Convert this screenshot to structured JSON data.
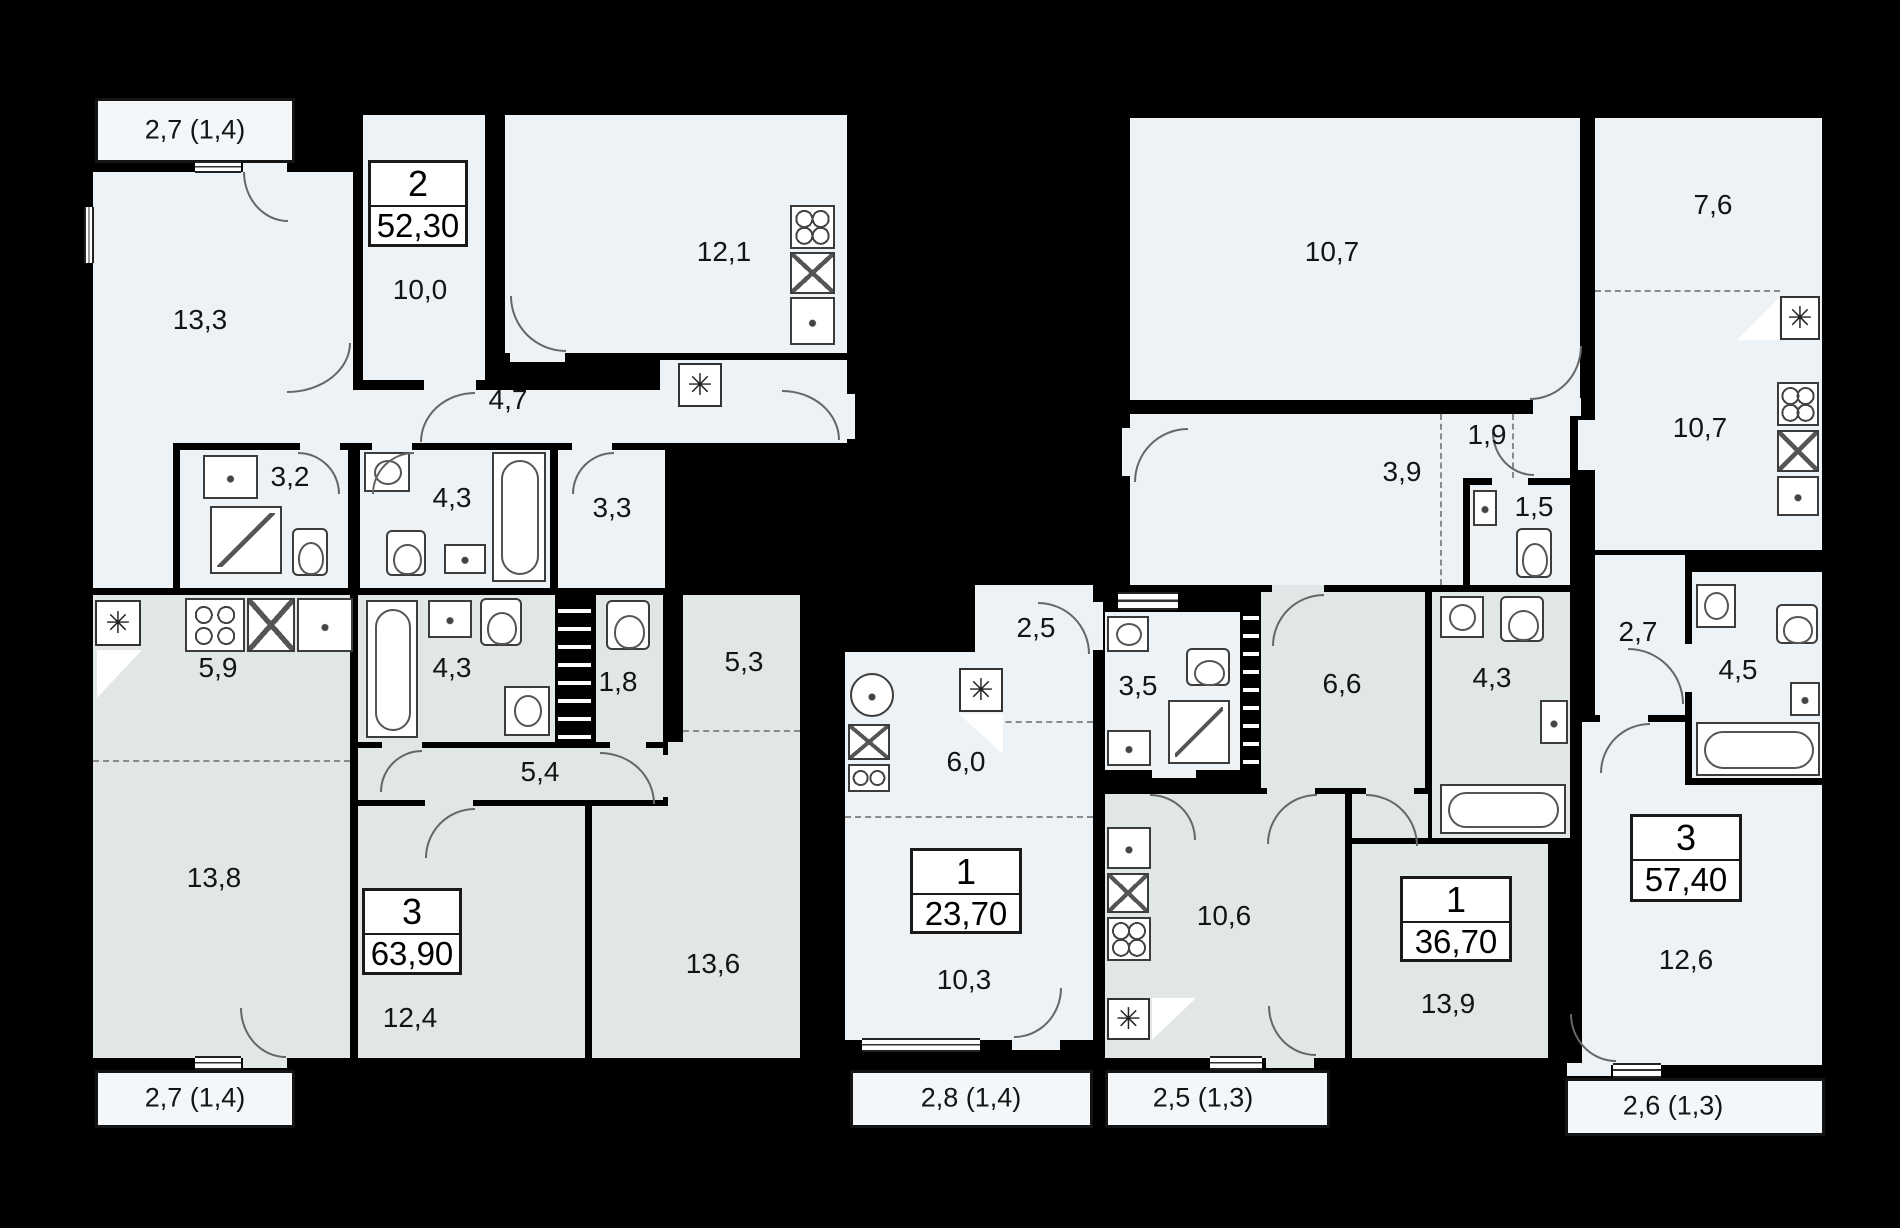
{
  "title": "Residential floor plan",
  "colors": {
    "wall": "#000000",
    "apartment_light": "#edf2f6",
    "apartment_dark": "#e1e6e7",
    "balcony": "#f3f7f9"
  },
  "symbols": {
    "vent": "✳"
  },
  "apartments": [
    {
      "id": "apt-2r",
      "type": "2",
      "area": "52,30",
      "balcony": "2,7 (1,4)",
      "rooms": {
        "r133": "13,3",
        "r100": "10,0",
        "k121": "12,1",
        "h47": "4,7",
        "b32": "3,2",
        "b43": "4,3",
        "r33": "3,3"
      }
    },
    {
      "id": "apt-3r-left",
      "type": "3",
      "area": "63,90",
      "balcony": "2,7 (1,4)",
      "rooms": {
        "k59": "5,9",
        "b43": "4,3",
        "wc18": "1,8",
        "r53": "5,3",
        "h54": "5,4",
        "r138": "13,8",
        "r124": "12,4",
        "r136": "13,6"
      }
    },
    {
      "id": "apt-1r-small",
      "type": "1",
      "area": "23,70",
      "balcony": "2,8 (1,4)",
      "rooms": {
        "h25": "2,5",
        "k60": "6,0",
        "r103": "10,3"
      }
    },
    {
      "id": "apt-1r-big",
      "type": "1",
      "area": "36,70",
      "balcony": "2,5 (1,3)",
      "rooms": {
        "b35": "3,5",
        "h66": "6,6",
        "b43": "4,3",
        "k106": "10,6",
        "r139": "13,9"
      }
    },
    {
      "id": "apt-3r-right",
      "type": "3",
      "area": "57,40",
      "balcony": "2,6 (1,3)",
      "rooms": {
        "r107": "10,7",
        "r76": "7,6",
        "k107": "10,7",
        "h39": "3,9",
        "c19": "1,9",
        "wc15": "1,5",
        "h27": "2,7",
        "b45": "4,5",
        "r126": "12,6"
      }
    }
  ]
}
